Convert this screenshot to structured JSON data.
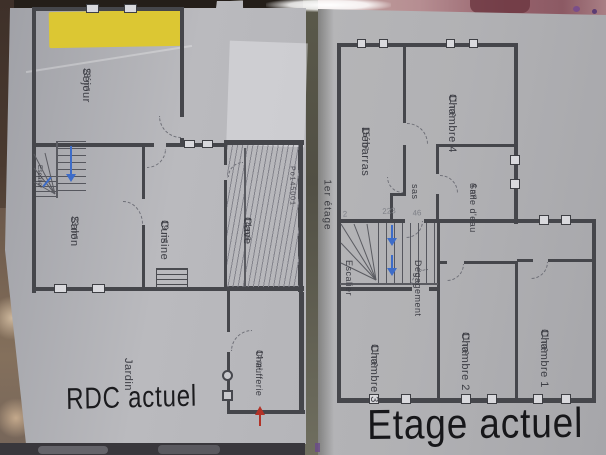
{
  "rdc": {
    "caption": "RDC actuel",
    "rooms": {
      "sejour": {
        "name": "Séjour",
        "area": "28 m²"
      },
      "salon": {
        "name": "Salon",
        "area": "23 m²"
      },
      "cuisine": {
        "name": "Cuisine",
        "area": "19 m²"
      },
      "cave": {
        "name": "Cave",
        "area": "14 m²"
      },
      "chaufferie": {
        "name": "Chaufferie",
        "area": "14 m²"
      },
      "jardin": {
        "name": "Jardin"
      },
      "escalier": {
        "name": "Escalier"
      }
    },
    "stamp": "Po145001"
  },
  "etage": {
    "caption": "Etage actuel",
    "floor_label": "1er étage",
    "rooms": {
      "chambre4": {
        "name": "Chambre 4",
        "area": "11 m²"
      },
      "debarras": {
        "name": "Débarras",
        "area": "15 m²"
      },
      "salle_eau": {
        "name": "Salle d'eau",
        "area": "4 m²"
      },
      "sas": {
        "name": "sas"
      },
      "degagement": {
        "name": "Dégagement"
      },
      "escalier": {
        "name": "Escalier"
      },
      "chambre3": {
        "name": "Chambre 3",
        "area": "11 m²"
      },
      "chambre2": {
        "name": "Chambre 2",
        "area": "11 m²"
      },
      "chambre1": {
        "name": "Chambre 1",
        "area": "11 m²"
      }
    },
    "pencil_notes": [
      "2",
      "223",
      "46"
    ]
  },
  "colors": {
    "wall": "#45464b",
    "paper": "#b5b5b9",
    "highlight_yellow": "#dcc733",
    "arrow_blue": "#3d6cc9",
    "arrow_red": "#b23227",
    "caption_text": "#1b1b1e"
  }
}
